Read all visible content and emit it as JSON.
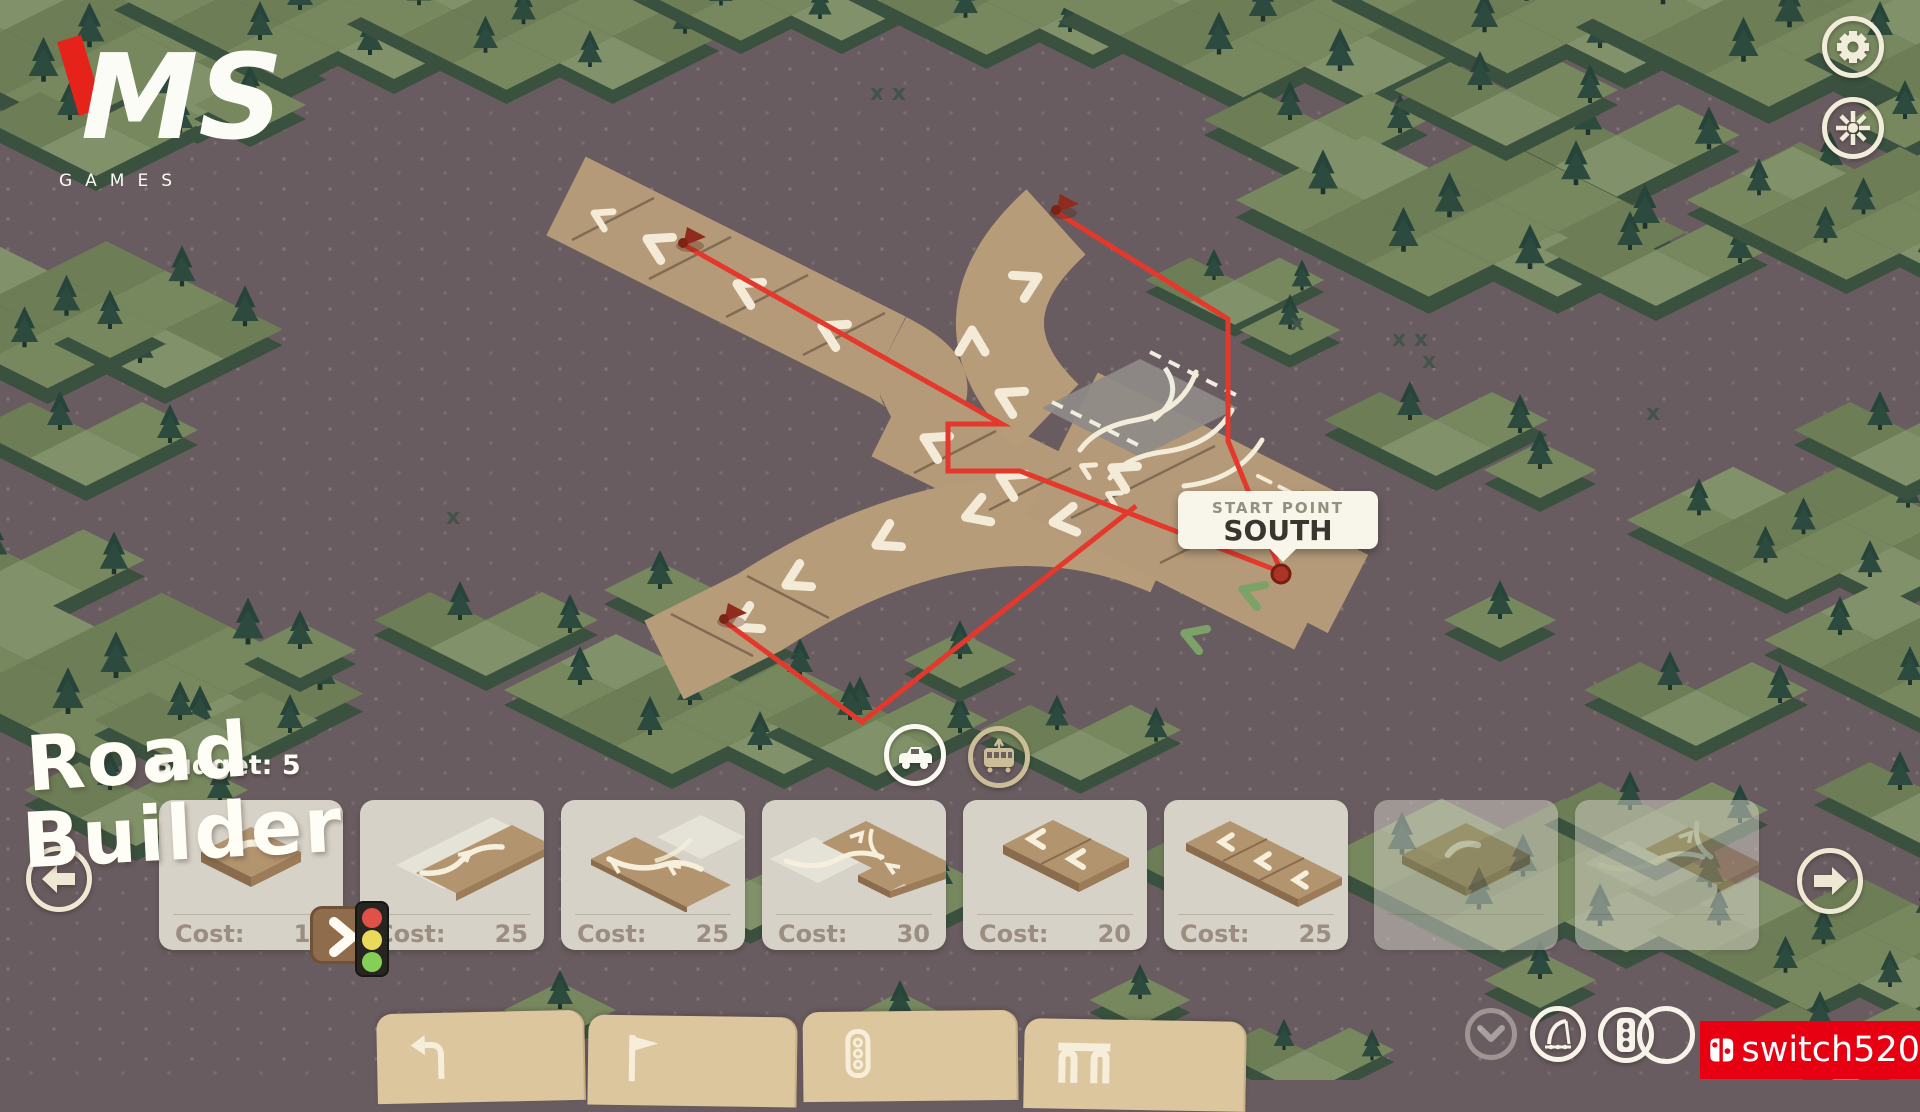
{
  "colors": {
    "accent_red": "#e8372e",
    "brand_red": "#e60012",
    "road_tan": "#b49a78",
    "card_bg": "#d6d2c8",
    "forest_green": "#6d7e57",
    "ground": "#695c60",
    "tab_tan": "#dcc69e"
  },
  "logo": {
    "title": "MS",
    "subtitle": "GAMES"
  },
  "map": {
    "tooltip": {
      "label": "START POINT",
      "value": "SOUTH"
    }
  },
  "hud": {
    "budget": "Budget: 5"
  },
  "toolbar": {
    "cards": [
      {
        "icon": "tile-single-turn",
        "cost_label": "Cost:",
        "cost": "10",
        "enabled": true
      },
      {
        "icon": "tile-lane-change",
        "cost_label": "Cost:",
        "cost": "25",
        "enabled": true
      },
      {
        "icon": "tile-exit-ramp",
        "cost_label": "Cost:",
        "cost": "25",
        "enabled": true
      },
      {
        "icon": "tile-junction",
        "cost_label": "Cost:",
        "cost": "30",
        "enabled": true
      },
      {
        "icon": "tile-straight-2",
        "cost_label": "Cost:",
        "cost": "20",
        "enabled": true
      },
      {
        "icon": "tile-straight-3",
        "cost_label": "Cost:",
        "cost": "25",
        "enabled": true
      },
      {
        "icon": "tile-wide-turn",
        "enabled": false
      },
      {
        "icon": "tile-junction-curve",
        "enabled": false
      }
    ]
  },
  "vehicles": {
    "active": "car",
    "options": [
      "car",
      "tram"
    ]
  },
  "tabs": [
    {
      "icon": "turn-left-arrow"
    },
    {
      "icon": "flag"
    },
    {
      "icon": "traffic-light"
    },
    {
      "icon": "bridge"
    }
  ],
  "watermark": {
    "line1": "Road",
    "line2": "Builder"
  },
  "brand": {
    "name": "switch520"
  }
}
